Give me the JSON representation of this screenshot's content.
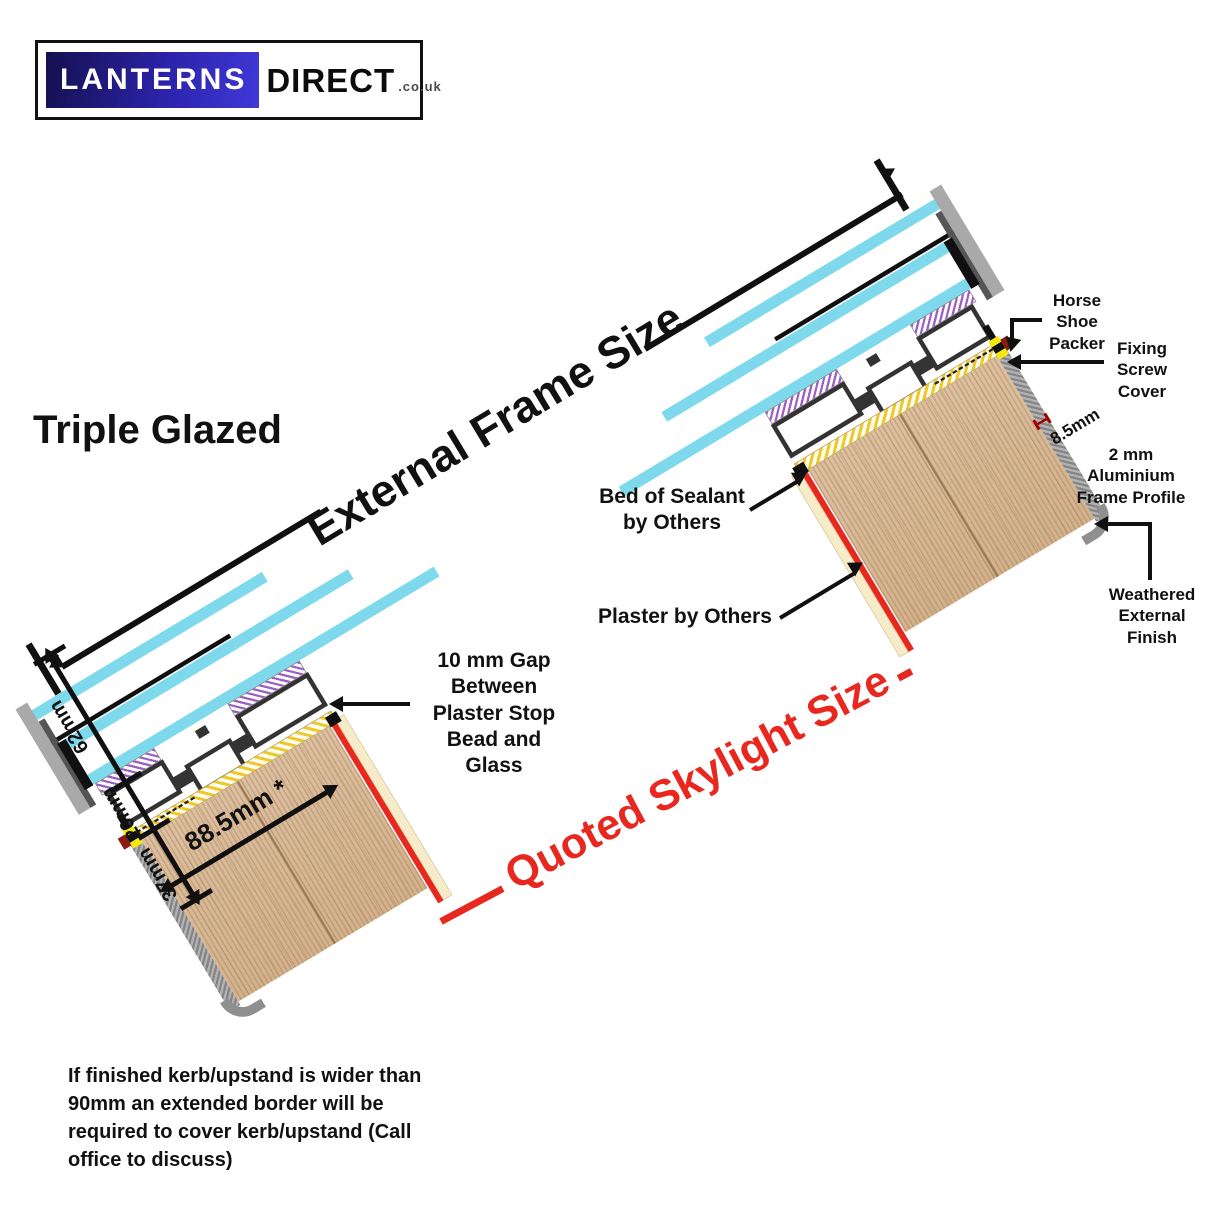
{
  "logo": {
    "brand_left": "LANTERNS",
    "brand_right": "DIRECT",
    "tld": ".co.uk"
  },
  "title": "Triple Glazed",
  "dimension_labels": {
    "external_frame_size": "External Frame Size",
    "quoted_skylight_size": "Quoted Skylight Size",
    "glass_unit_thickness": "62mm",
    "frame_height": "20mm",
    "packer_zone": "37mm",
    "kerb_top_width": "88.5mm *",
    "profile_edge": "8.5mm"
  },
  "ann": {
    "horse_shoe_packer": "Horse Shoe Packer",
    "fixing_screw_cover": "Fixing Screw Cover",
    "aluminium_profile": "2 mm Aluminium Frame Profile",
    "weathered_finish": "Weathered External Finish",
    "bed_of_sealant": "Bed of Sealant by Others",
    "plaster": "Plaster by Others",
    "plaster_gap": "10 mm Gap Between Plaster Stop Bead and Glass"
  },
  "footnote": "If finished kerb/upstand is wider than 90mm an extended border will be required to cover kerb/upstand (Call office to discuss)",
  "colors": {
    "glass_cyan": "#7fd9ec",
    "dimension_red": "#e8281e",
    "timber": "#d9bc9c",
    "sealant_yellow": "#edc82c",
    "gasket_purple": "#9d5fc2",
    "plaster_cream": "#f6ecca",
    "weathered_gray": "#9a9a9a",
    "logo_navy": "#14104e",
    "logo_blue": "#4038d8",
    "ink": "#111111"
  }
}
